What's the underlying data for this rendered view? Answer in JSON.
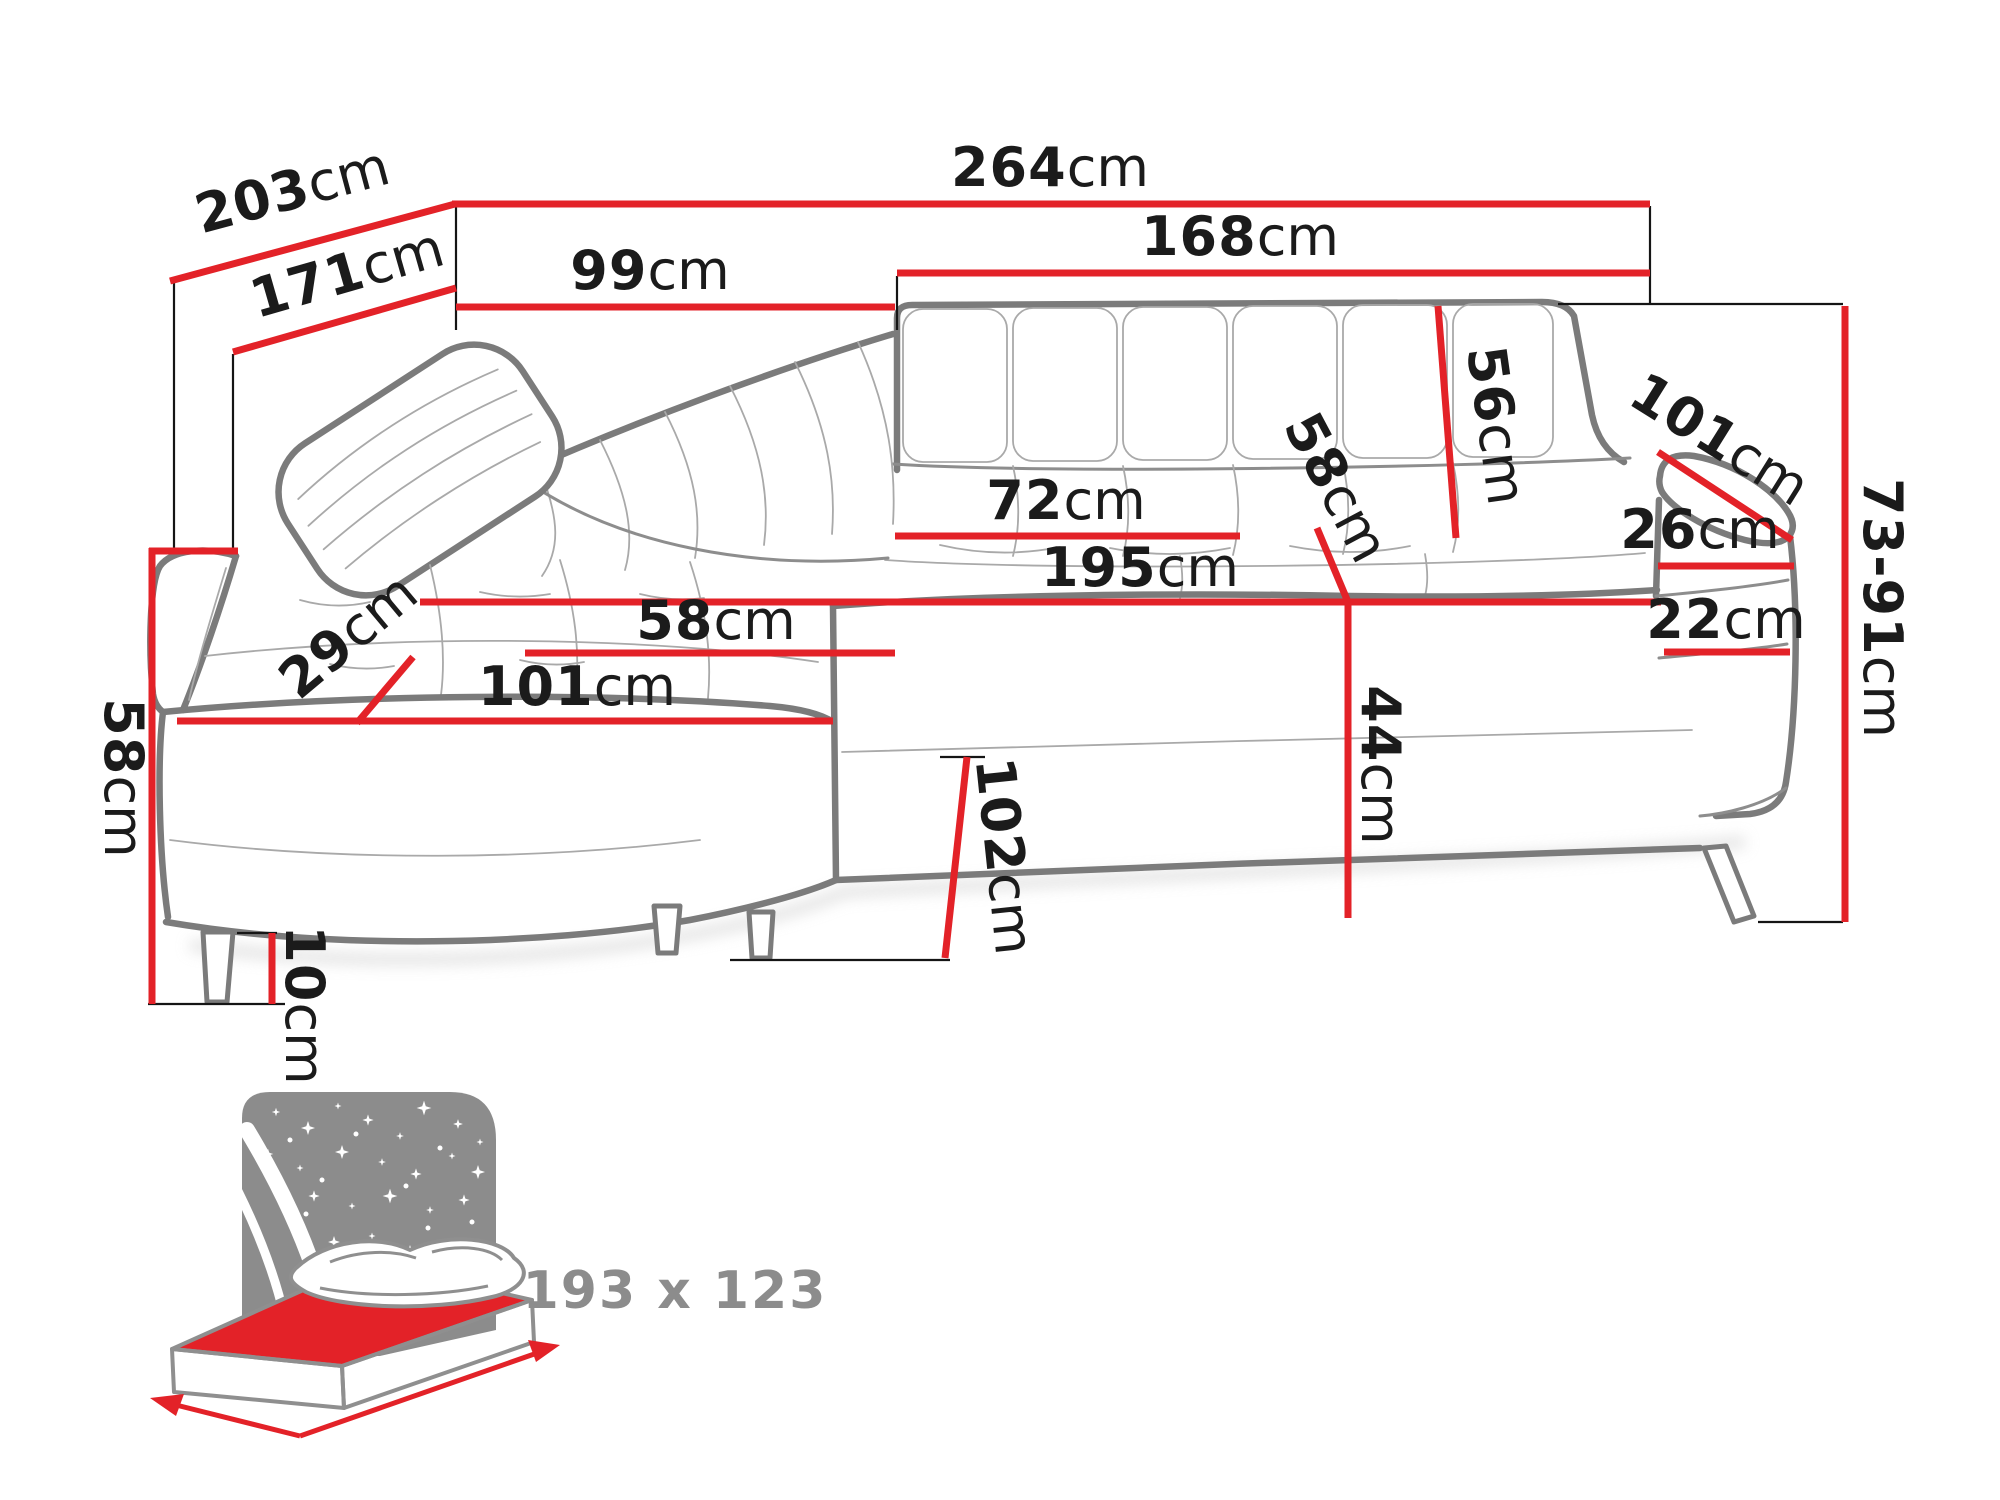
{
  "diagram": {
    "title_semantic": "corner-sofa-dimension-diagram",
    "dimensions": [
      {
        "id": "depth-total",
        "num": "203",
        "unit": "cm"
      },
      {
        "id": "width-total",
        "num": "264",
        "unit": "cm"
      },
      {
        "id": "depth-inner",
        "num": "171",
        "unit": "cm"
      },
      {
        "id": "back-left-width",
        "num": "99",
        "unit": "cm"
      },
      {
        "id": "back-right-width",
        "num": "168",
        "unit": "cm"
      },
      {
        "id": "backrest-height",
        "num": "56",
        "unit": "cm"
      },
      {
        "id": "armrest-length",
        "num": "101",
        "unit": "cm"
      },
      {
        "id": "armrest-top-width",
        "num": "26",
        "unit": "cm"
      },
      {
        "id": "height-adjustable",
        "num": "73-91",
        "unit": "cm"
      },
      {
        "id": "armrest-side-width",
        "num": "22",
        "unit": "cm"
      },
      {
        "id": "seat-back-width",
        "num": "72",
        "unit": "cm"
      },
      {
        "id": "seat-depth-right",
        "num": "58",
        "unit": "cm"
      },
      {
        "id": "seat-front-width",
        "num": "195",
        "unit": "cm"
      },
      {
        "id": "chaise-seat-depth",
        "num": "58",
        "unit": "cm"
      },
      {
        "id": "arm-pad-width",
        "num": "29",
        "unit": "cm"
      },
      {
        "id": "chaise-front-width",
        "num": "101",
        "unit": "cm"
      },
      {
        "id": "side-height",
        "num": "58",
        "unit": "cm"
      },
      {
        "id": "seat-height",
        "num": "44",
        "unit": "cm"
      },
      {
        "id": "leg-height",
        "num": "10",
        "unit": "cm"
      },
      {
        "id": "chaise-depth",
        "num": "102",
        "unit": "cm"
      }
    ],
    "sleeping_area": {
      "label": "193 x 123"
    },
    "colors": {
      "dimension_red": "#e32228",
      "outline_gray": "#7b7b7b",
      "icon_gray": "#8c8c8c",
      "text_black": "#1b1b1b"
    }
  }
}
